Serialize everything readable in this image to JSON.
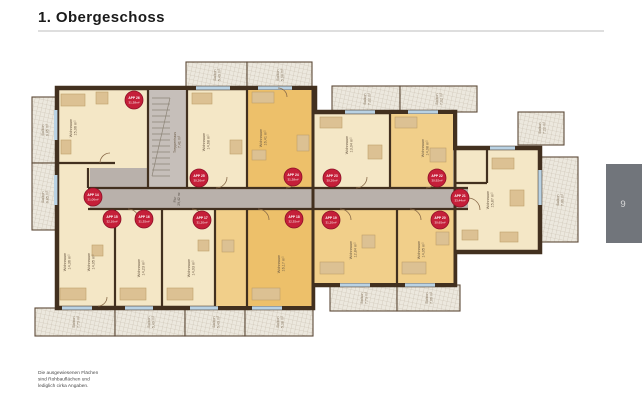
{
  "title": "1. Obergeschoss",
  "page_number": "9",
  "disclaimer": [
    "Die ausgewiesenen Flächen",
    "sind Rohbauflächen und",
    "lediglich cirka Angaben."
  ],
  "colors": {
    "badge": "#c51f39",
    "wall": "#42301f",
    "room_cream": "#f4e7c6",
    "room_amber": "#f1cf8a",
    "room_deep_amber": "#edc06a",
    "corridor_gray": "#b9b1ab",
    "stair_gray": "#c6bfba",
    "page_box": "#71757b",
    "title_rule": "#c9c9c9"
  },
  "plan": {
    "stairwell": {
      "label": "Treppenhaus",
      "area": "7,41 m²"
    },
    "corridor": {
      "label": "Flur",
      "area": "29,42 m²"
    },
    "rooms": [
      {
        "name": "Wohnraum",
        "area": "15,06 m²",
        "x": 72,
        "y": 128
      },
      {
        "name": "Wohnraum",
        "area": "14,68 m²",
        "x": 205,
        "y": 142
      },
      {
        "name": "Wohnraum",
        "area": "16,41 m²",
        "x": 262,
        "y": 138
      },
      {
        "name": "Wohnraum",
        "area": "13,04 m²",
        "x": 348,
        "y": 145
      },
      {
        "name": "Wohnraum",
        "area": "14,08 m²",
        "x": 424,
        "y": 148
      },
      {
        "name": "Wohnraum",
        "area": "15,87 m²",
        "x": 489,
        "y": 200
      },
      {
        "name": "Wohnraum",
        "area": "14,36 m²",
        "x": 66,
        "y": 262
      },
      {
        "name": "Wohnraum",
        "area": "14,05 m²",
        "x": 90,
        "y": 262
      },
      {
        "name": "Wohnraum",
        "area": "14,23 m²",
        "x": 140,
        "y": 268
      },
      {
        "name": "Wohnraum",
        "area": "14,03 m²",
        "x": 190,
        "y": 268
      },
      {
        "name": "Wohnraum",
        "area": "16,17 m²",
        "x": 280,
        "y": 264
      },
      {
        "name": "Wohnraum",
        "area": "12,84 m²",
        "x": 352,
        "y": 250
      },
      {
        "name": "Wohnraum",
        "area": "14,05 m²",
        "x": 420,
        "y": 250
      }
    ],
    "balconies": [
      {
        "name": "Balkon",
        "area": "6,85 m²",
        "x": 44,
        "y": 130
      },
      {
        "name": "Balkon",
        "area": "6,85 m²",
        "x": 44,
        "y": 197
      },
      {
        "name": "Balkon",
        "area": "5,49 m²",
        "x": 216,
        "y": 75
      },
      {
        "name": "Balkon",
        "area": "5,38 m²",
        "x": 279,
        "y": 75
      },
      {
        "name": "Balkon",
        "area": "7,22 m²",
        "x": 366,
        "y": 99
      },
      {
        "name": "Balkon",
        "area": "7,02 m²",
        "x": 438,
        "y": 99
      },
      {
        "name": "Balkon",
        "area": "7,22 m²",
        "x": 541,
        "y": 128
      },
      {
        "name": "Balkon",
        "area": "7,06 m²",
        "x": 559,
        "y": 200
      },
      {
        "name": "Balkon",
        "area": "7,73 m²",
        "x": 75,
        "y": 322
      },
      {
        "name": "Balkon",
        "area": "5,49 m²",
        "x": 150,
        "y": 322
      },
      {
        "name": "Balkon",
        "area": "5,49 m²",
        "x": 215,
        "y": 322
      },
      {
        "name": "Balkon",
        "area": "5,38 m²",
        "x": 279,
        "y": 322
      },
      {
        "name": "Balkon",
        "area": "7,73 m²",
        "x": 363,
        "y": 298
      },
      {
        "name": "Balkon",
        "area": "7,06 m²",
        "x": 428,
        "y": 298
      }
    ],
    "badges": [
      {
        "app": "APP 26",
        "area": "31,38m²",
        "x": 134,
        "y": 100
      },
      {
        "app": "APP 25",
        "area": "30,26m²",
        "x": 199,
        "y": 178
      },
      {
        "app": "APP 24",
        "area": "31,38m²",
        "x": 293,
        "y": 177
      },
      {
        "app": "APP 23",
        "area": "30,26m²",
        "x": 332,
        "y": 178
      },
      {
        "app": "APP 22",
        "area": "30,92m²",
        "x": 437,
        "y": 178
      },
      {
        "app": "APP 21",
        "area": "33,44m²",
        "x": 460,
        "y": 198
      },
      {
        "app": "APP 14",
        "area": "31,06m²",
        "x": 93,
        "y": 197
      },
      {
        "app": "APP 15",
        "area": "32,16m²",
        "x": 112,
        "y": 219
      },
      {
        "app": "APP 16",
        "area": "31,35m²",
        "x": 144,
        "y": 219
      },
      {
        "app": "APP 17",
        "area": "31,20m²",
        "x": 202,
        "y": 220
      },
      {
        "app": "APP 18",
        "area": "32,35m²",
        "x": 294,
        "y": 219
      },
      {
        "app": "APP 19",
        "area": "31,20m²",
        "x": 331,
        "y": 220
      },
      {
        "app": "APP 20",
        "area": "30,65m²",
        "x": 440,
        "y": 220
      }
    ]
  }
}
